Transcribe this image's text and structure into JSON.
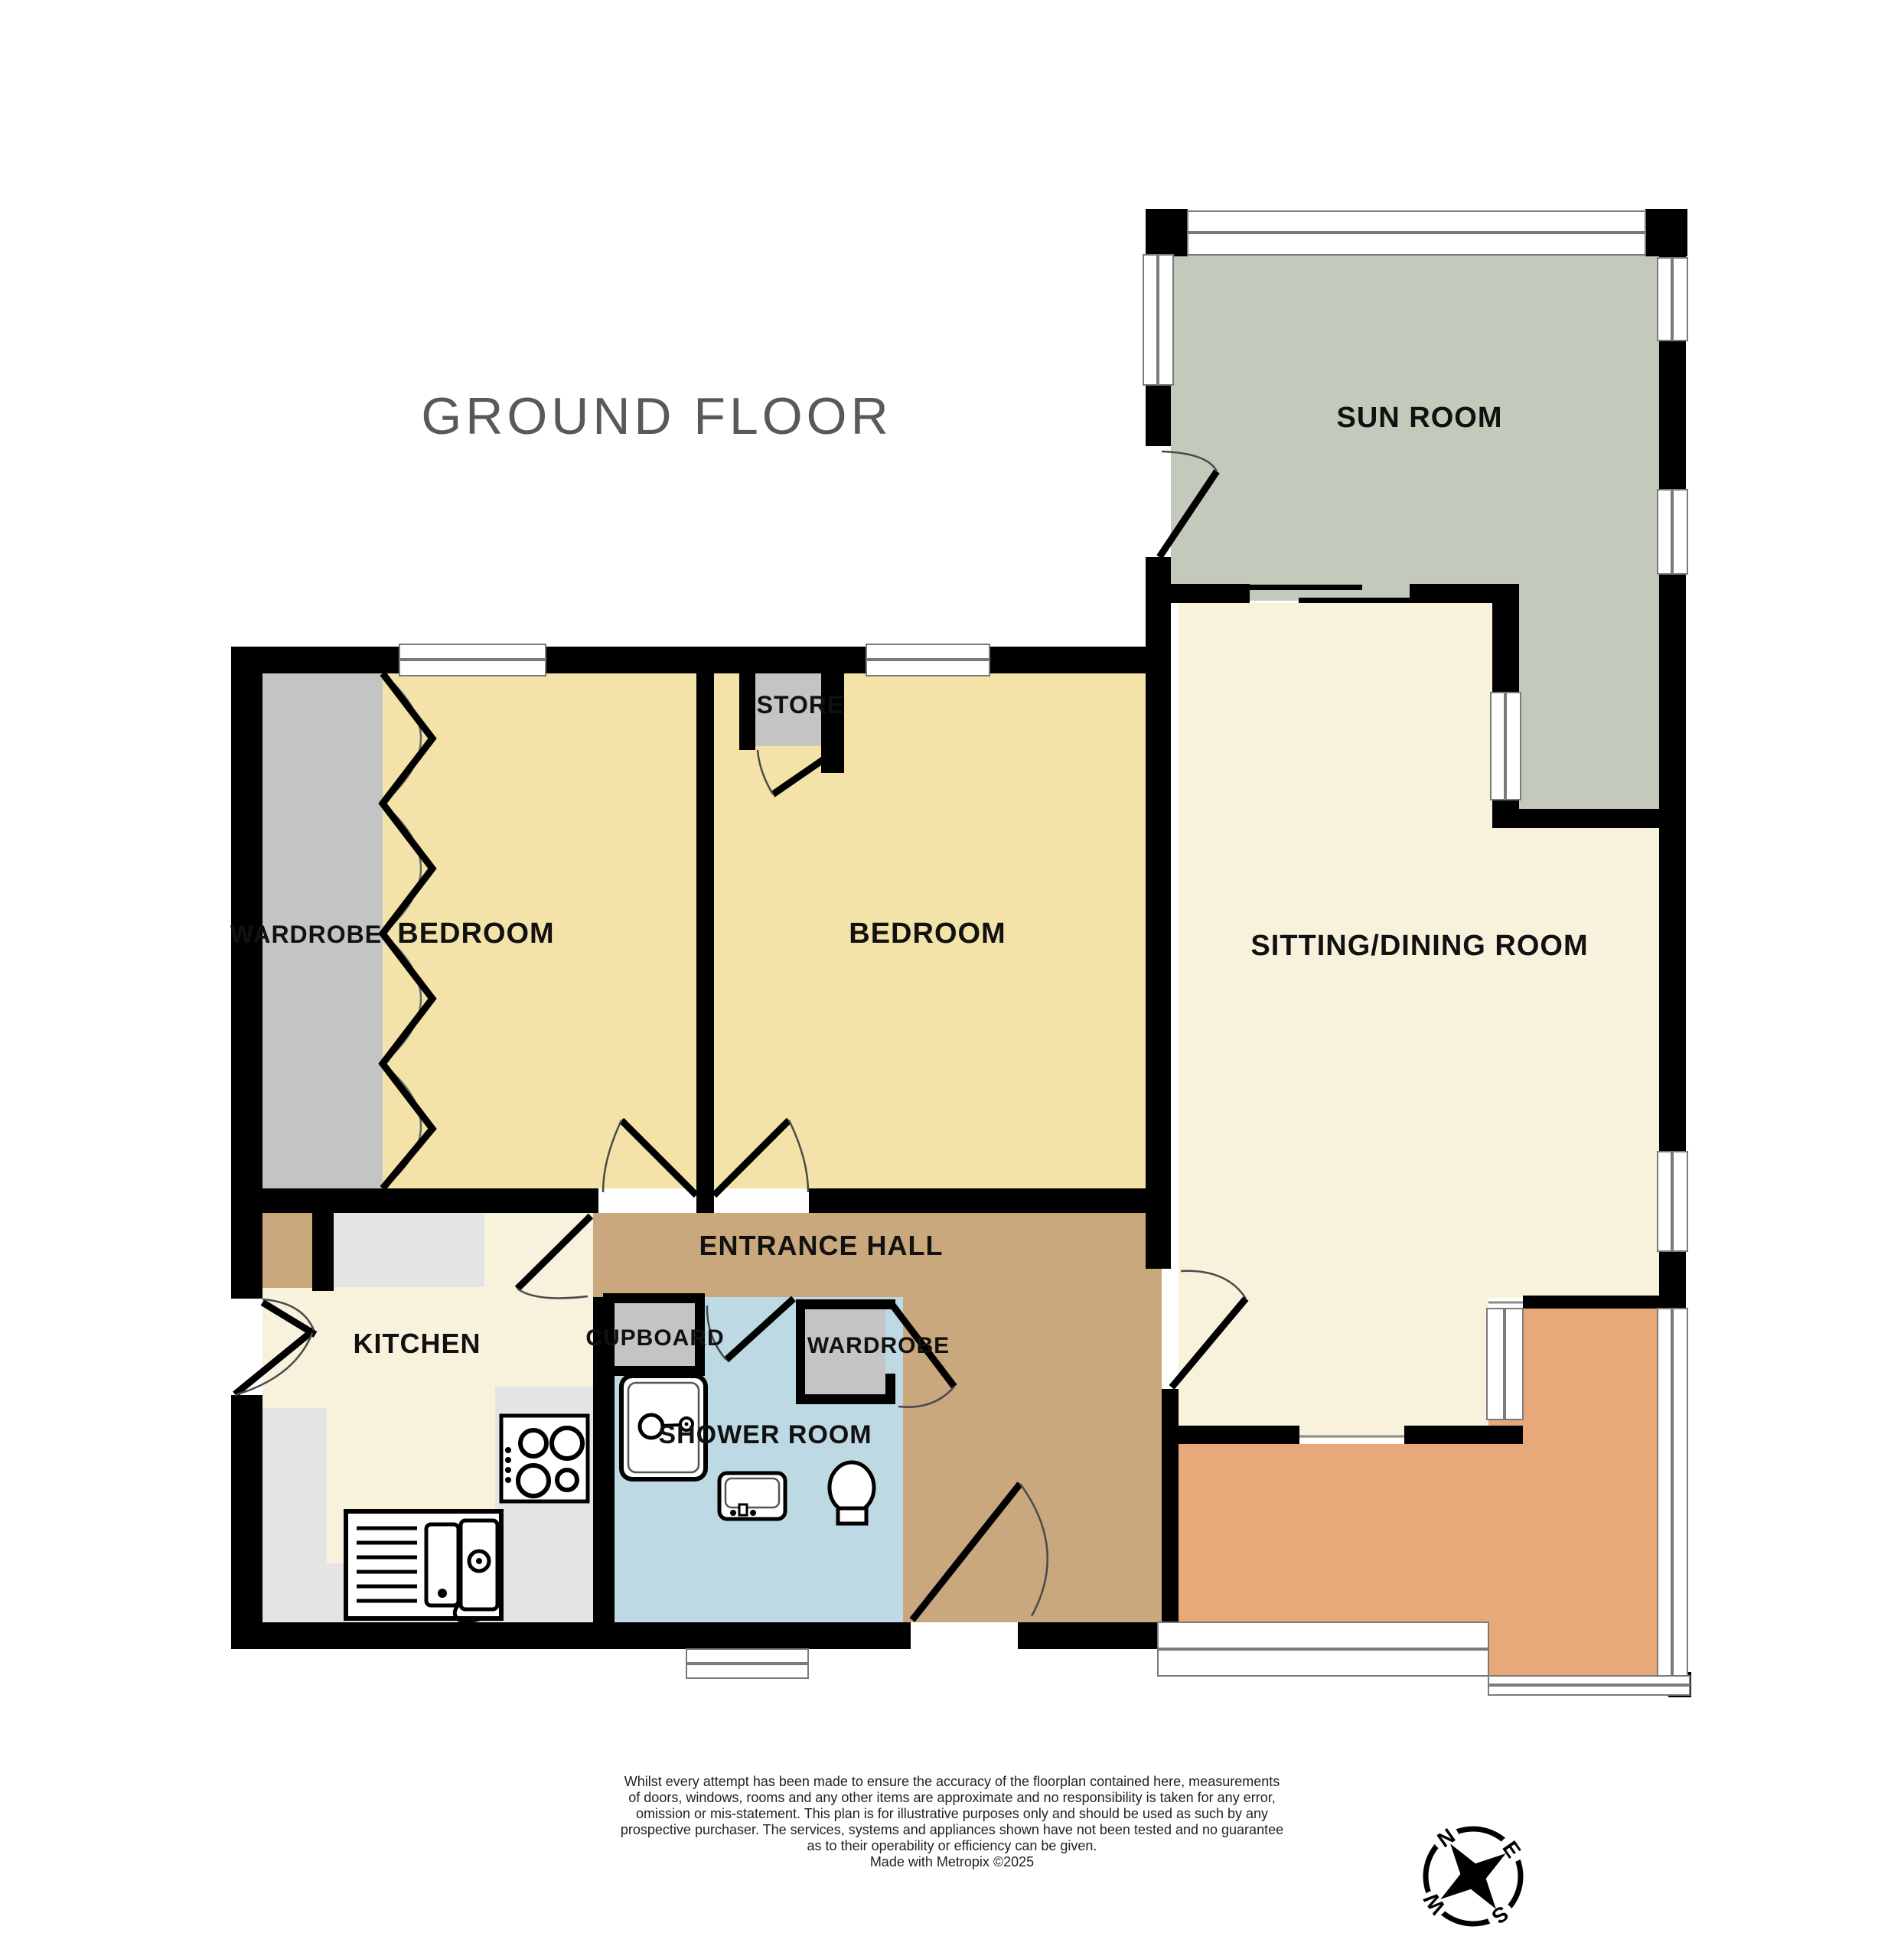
{
  "title": "GROUND FLOOR",
  "rooms": {
    "sun_room": "SUN ROOM",
    "sitting_dining_room": "SITTING/DINING ROOM",
    "bedroom_1": "BEDROOM",
    "bedroom_2": "BEDROOM",
    "store": "STORE",
    "bedroom_wardrobe": "WARDROBE",
    "kitchen": "KITCHEN",
    "entrance_hall": "ENTRANCE HALL",
    "cupboard": "CUPBOARD",
    "hall_wardrobe": "WARDROBE",
    "shower_room": "SHOWER ROOM"
  },
  "compass": {
    "north": "N",
    "east": "E",
    "south": "S",
    "west": "W"
  },
  "disclaimer": {
    "lines": [
      "Whilst every attempt has been made to ensure the accuracy of the floorplan contained here, measurements",
      "of doors, windows, rooms and any other items are approximate and no responsibility is taken for any error,",
      "omission or mis-statement. This plan is for illustrative purposes only and should be used as such by any",
      "prospective purchaser. The services, systems and appliances shown have not been tested and no guarantee",
      "as to their operability or efficiency can be given."
    ],
    "credit": "Made with Metropix ©2025"
  },
  "icons": {
    "compass": "compass-rose",
    "hob": "four-burner-hob",
    "sink": "kitchen-sink-with-drainer",
    "shower": "shower-cubicle",
    "basin": "wash-basin",
    "toilet": "toilet"
  },
  "palette": {
    "c-wall": "#000000",
    "c-green": "#c3cabb",
    "c-cream": "#f8f2dd",
    "c-yellow": "#f3e3a8",
    "c-gray": "#c4c4c4",
    "c-counter": "#e4e4e4",
    "c-tan": "#c9a87e",
    "c-blue": "#bdd9e3",
    "c-orange": "#e8a97a",
    "c-winline": "#7a7a7a",
    "c-title": "#595959",
    "c-label": "#111111",
    "c-disc": "#222222"
  }
}
